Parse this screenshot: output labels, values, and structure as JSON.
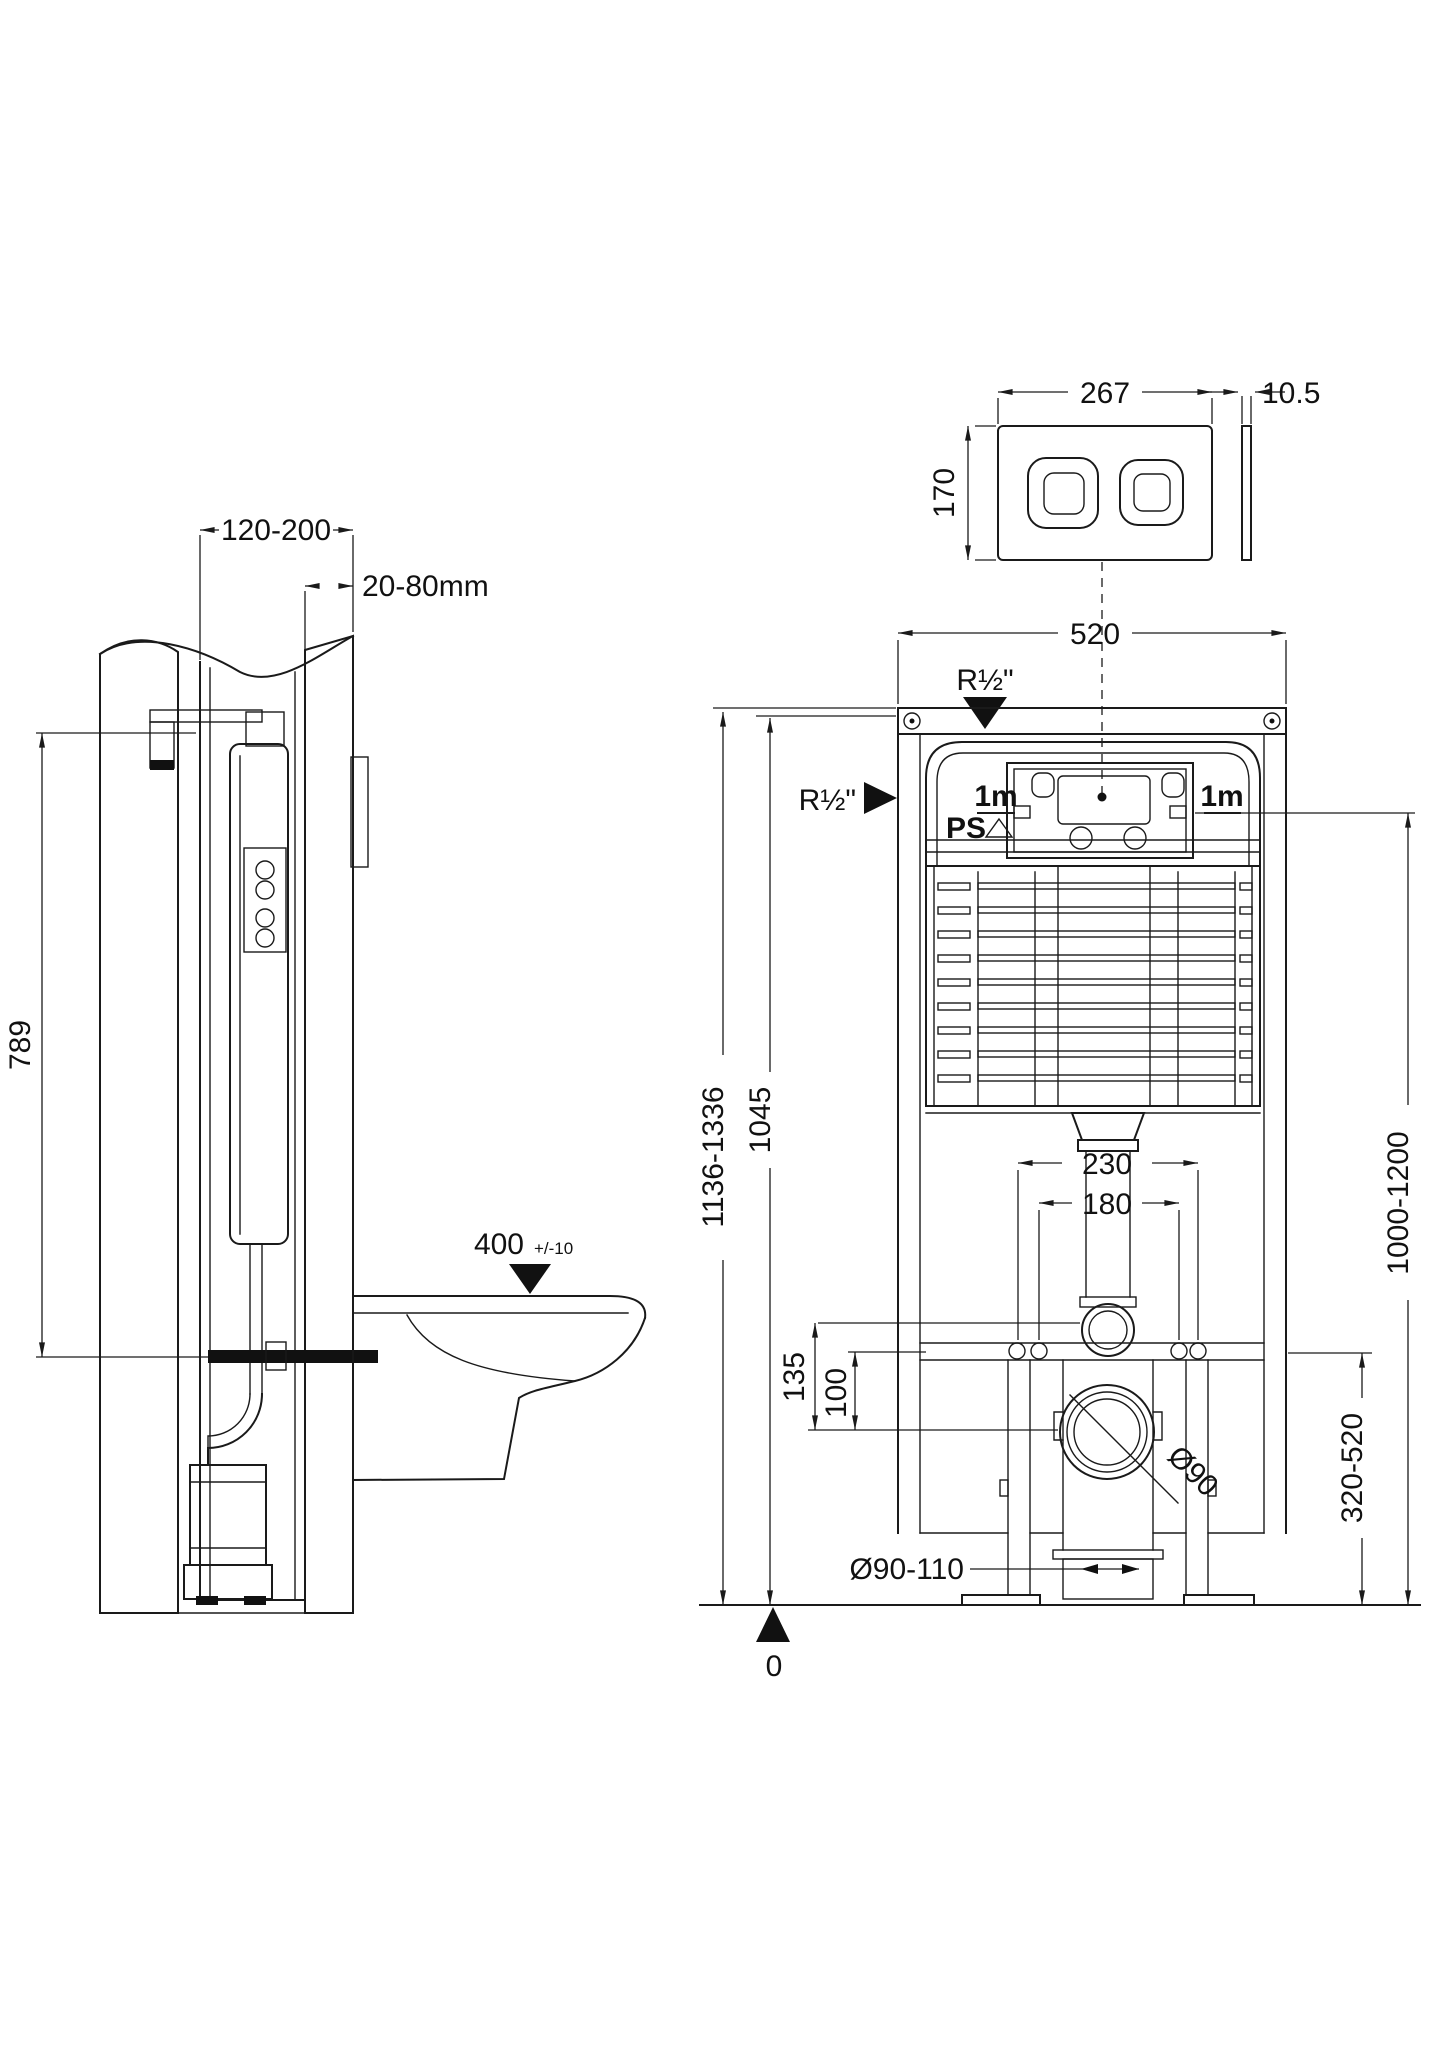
{
  "colors": {
    "line": "#1a1a1a",
    "background": "#ffffff"
  },
  "views": {
    "side": {
      "dim_frame_depth": "120-200",
      "dim_wall_finish": "20-80mm",
      "dim_tank_height": "789",
      "dim_seat_height": "400",
      "dim_seat_tolerance": "+/-10"
    },
    "plate": {
      "dim_width": "267",
      "dim_height": "170",
      "dim_thickness": "10.5"
    },
    "front": {
      "dim_frame_width": "520",
      "water_inlet_top": "R½\"",
      "water_inlet_side": "R½\"",
      "hose_left": "1m",
      "hose_left_tag": "PS",
      "hose_right": "1m",
      "dim_overall_height": "1136-1336",
      "dim_frame_height": "1045",
      "dim_inlet_height": "1000-1200",
      "dim_fixing_centres": "230",
      "dim_flush_centres": "180",
      "dim_flush_offset": "135",
      "dim_fixing_offset": "100",
      "dim_outlet_height": "320-520",
      "dim_outlet_dia": "Ø90",
      "dim_waste_dia": "Ø90-110",
      "datum": "0"
    }
  }
}
